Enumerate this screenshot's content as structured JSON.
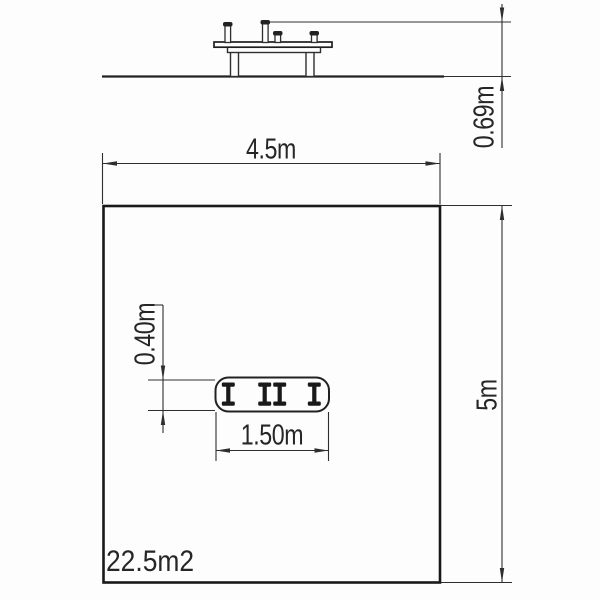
{
  "elevation_view": {
    "height_dimension_label": "0.69m"
  },
  "plan_view": {
    "width_dimension_label": "4.5m",
    "depth_dimension_label": "5m",
    "area_label": "22.5m2",
    "footprint": {
      "length_dimension_label": "1.50m",
      "width_dimension_label": "0.40m"
    }
  },
  "colors": {
    "background": "#fdfdfd",
    "thin_line": "#2e2e2e",
    "heavy_line": "#1a1a1a",
    "text": "#262626"
  }
}
